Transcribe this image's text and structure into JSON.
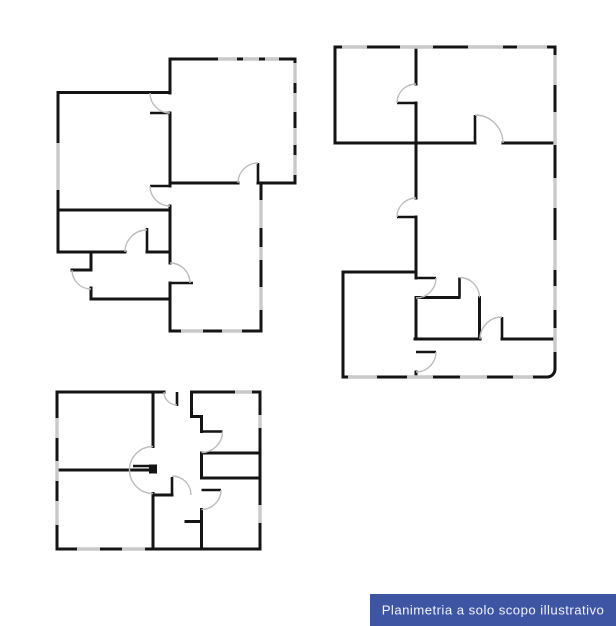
{
  "banner": {
    "label": "Planimetria a solo scopo illustrativo",
    "background_color": "#3d55a3",
    "text_color": "#f2f4f9"
  },
  "colors": {
    "canvas": "#ffffff",
    "wall": "#141414",
    "door_arc": "#bdbdbd",
    "window": "#c9c9c9"
  }
}
